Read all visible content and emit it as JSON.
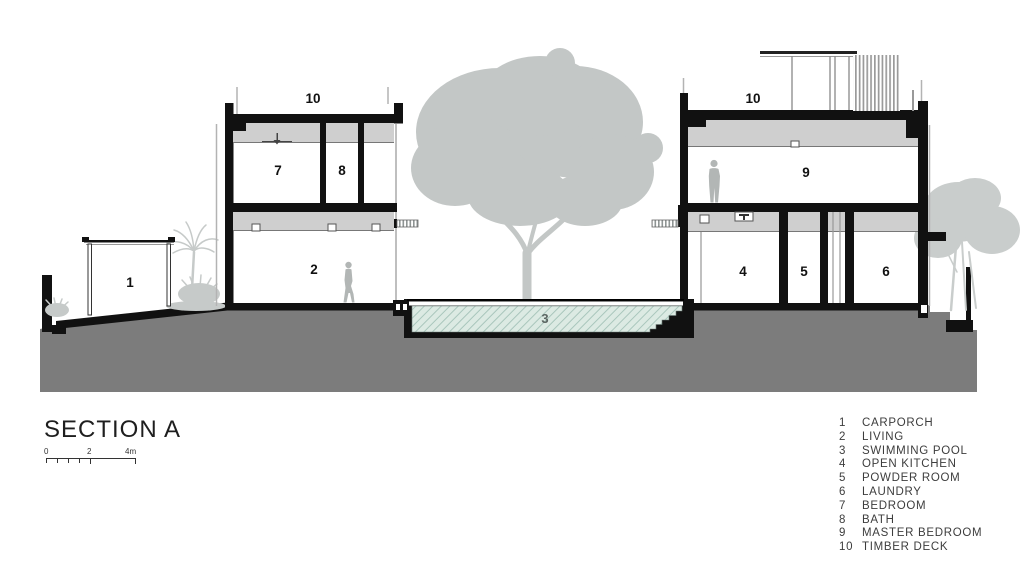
{
  "title": "SECTION A",
  "scalebar": {
    "zero": "0",
    "two": "2",
    "four": "4m"
  },
  "rooms": {
    "n1": "1",
    "n2": "2",
    "n3": "3",
    "n4": "4",
    "n5": "5",
    "n6": "6",
    "n7": "7",
    "n8": "8",
    "n9": "9",
    "n10": "10"
  },
  "legend": {
    "items": [
      {
        "num": "1",
        "label": "CARPORCH"
      },
      {
        "num": "2",
        "label": "LIVING"
      },
      {
        "num": "3",
        "label": "SWIMMING POOL"
      },
      {
        "num": "4",
        "label": "OPEN KITCHEN"
      },
      {
        "num": "5",
        "label": "POWDER ROOM"
      },
      {
        "num": "6",
        "label": "LAUNDRY"
      },
      {
        "num": "7",
        "label": "BEDROOM"
      },
      {
        "num": "8",
        "label": "BATH"
      },
      {
        "num": "9",
        "label": "MASTER BEDROOM"
      },
      {
        "num": "10",
        "label": "TIMBER DECK"
      }
    ]
  },
  "colors": {
    "wall": "#111111",
    "ground": "#7c7c7c",
    "ceiling_band": "#cfcfcf",
    "vegetation": "#c5c9c8",
    "people": "#b2b6b5",
    "pool_water": "#dceae3",
    "pool_hatch": "#a9c6bc"
  }
}
